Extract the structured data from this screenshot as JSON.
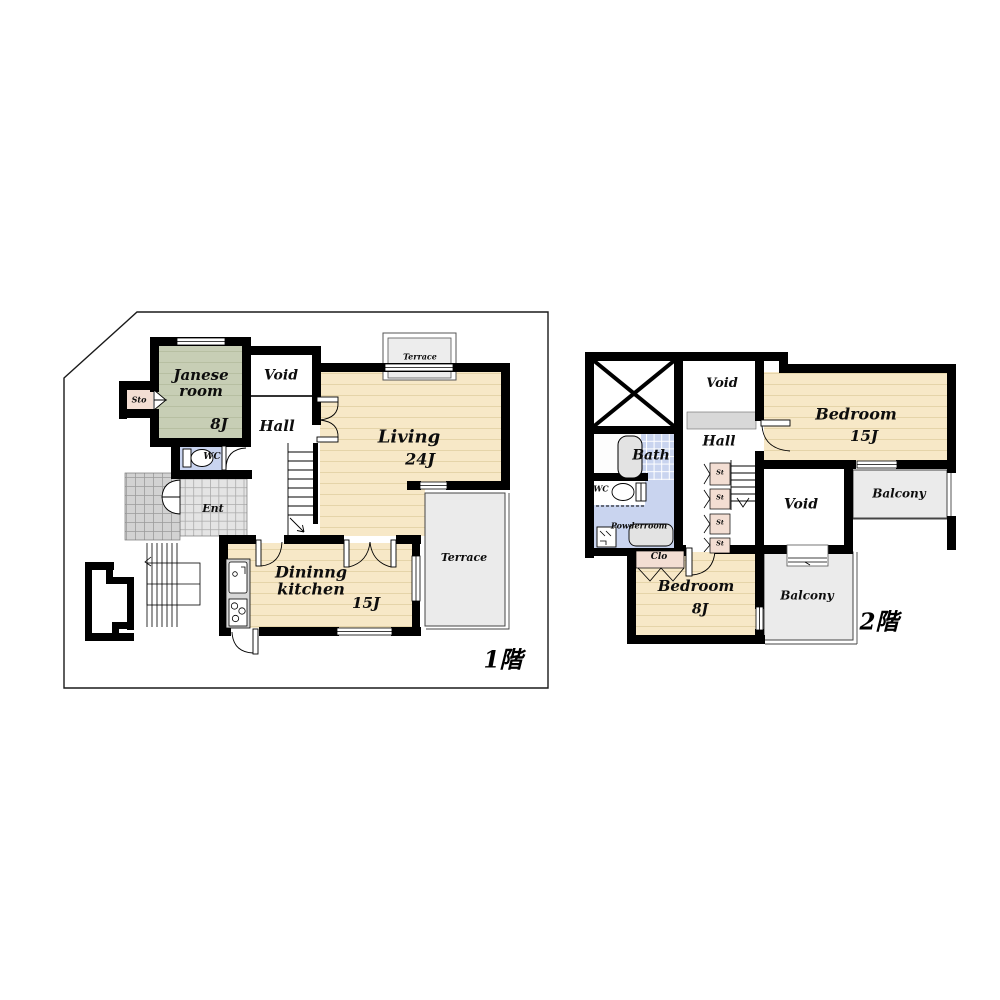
{
  "document": {
    "type": "floor-plan",
    "language": "ja/en"
  },
  "colors": {
    "wall": "#000000",
    "tatami_cream": "#f7e8c7",
    "tatami_stripe": "#e5d4a9",
    "japanese_green": "#c7ceb5",
    "wet_area_blue": "#c9d4ef",
    "closet_pink": "#f3ded3",
    "entrance_tile": "#e4e4e4",
    "porch_tile": "#d2d2d2",
    "balcony_gray": "#ebebeb",
    "fixture_gray": "#dcdcdc"
  },
  "floor1": {
    "title": "1階",
    "rooms": {
      "japanese_room": {
        "label": "Janese room",
        "size": "8J"
      },
      "storage": {
        "label": "Sto"
      },
      "void": {
        "label": "Void"
      },
      "hall": {
        "label": "Hall"
      },
      "wc": {
        "label": "WC"
      },
      "entrance": {
        "label": "Ent"
      },
      "living": {
        "label": "Living",
        "size": "24J"
      },
      "terrace_north": {
        "label": "Terrace"
      },
      "terrace_east": {
        "label": "Terrace"
      },
      "dining_kitchen": {
        "label": "Dininng kitchen",
        "size": "15J"
      }
    }
  },
  "floor2": {
    "title": "2階",
    "rooms": {
      "void_north": {
        "label": "Void"
      },
      "bedroom_15": {
        "label": "Bedroom",
        "size": "15J"
      },
      "bath": {
        "label": "Bath"
      },
      "hall": {
        "label": "Hall"
      },
      "wc": {
        "label": "WC"
      },
      "powder_room": {
        "label": "Powderroom"
      },
      "void_center": {
        "label": "Void"
      },
      "balcony_east": {
        "label": "Balcony"
      },
      "closet": {
        "label": "Clo"
      },
      "bedroom_8": {
        "label": "Bedroom",
        "size": "8J"
      },
      "balcony_south": {
        "label": "Balcony"
      }
    },
    "storages": [
      {
        "label": "St"
      },
      {
        "label": "St"
      },
      {
        "label": "St"
      },
      {
        "label": "St"
      }
    ]
  }
}
